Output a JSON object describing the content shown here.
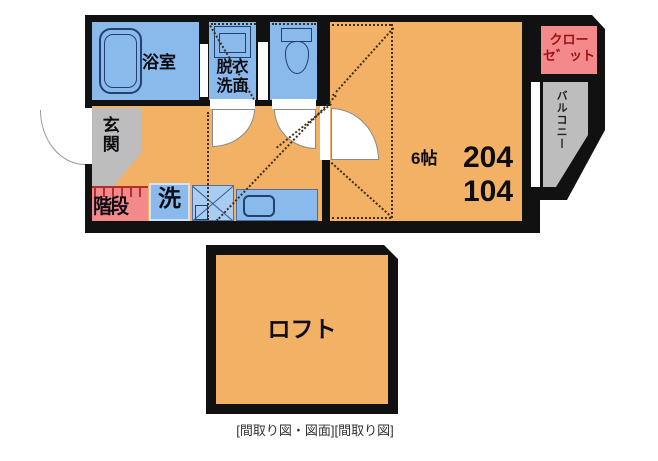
{
  "caption": "[間取り図・図面][間取り図]",
  "rooms": {
    "bathroom": {
      "label": "浴室"
    },
    "washroom": {
      "line1": "脱衣",
      "line2": "洗面"
    },
    "entrance": {
      "label": "玄関"
    },
    "stairs": {
      "label": "階段"
    },
    "washer": {
      "label": "洗"
    },
    "main": {
      "size": "6帖",
      "unit_upper": "204",
      "unit_lower": "104"
    },
    "closet": {
      "line1": "クロー",
      "line2": "セ゛ット"
    },
    "balcony": {
      "label": "バルコニー"
    },
    "loft": {
      "label": "ロフト"
    }
  },
  "colors": {
    "wall": "#111111",
    "room_orange": "#f2b165",
    "wet_area_blue": "#8abaec",
    "terrace_gray": "#bdbdbd",
    "stairs_closet_pink": "#f4898b",
    "closet_text_red": "#9b1111"
  }
}
